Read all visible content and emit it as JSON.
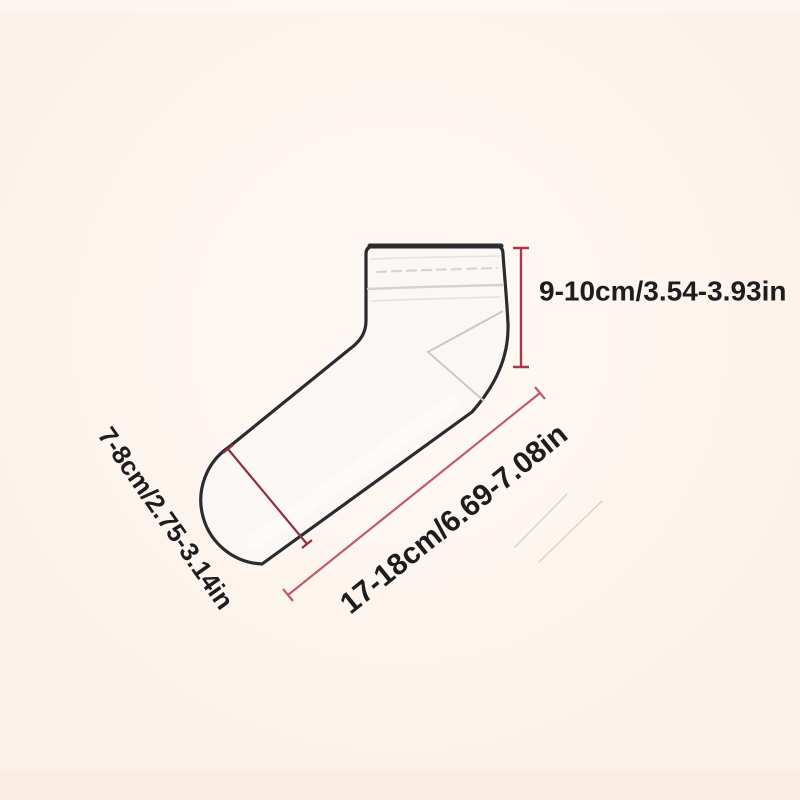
{
  "diagram": {
    "kind": "sock-size-guide",
    "subject": "low-cut ankle sock outline drawing",
    "labels": {
      "cuff_height": "9-10cm/3.54-3.93in",
      "foot_length": "17-18cm/6.69-7.08in",
      "toe_width": "7-8cm/2.75-3.14in"
    },
    "colors": {
      "background": "#fdf2ea",
      "sock_fill": "#faf7f4",
      "outline": "#2b2b30",
      "ribbing": "#d3d0cd",
      "heel_line": "#cbc8c5",
      "measure_vertical": "#a43a4c",
      "measure_diagonal": "#c05a6e",
      "measure_toe": "#8e3242",
      "streak": "#c2beba",
      "text": "#1d1d1f"
    }
  }
}
